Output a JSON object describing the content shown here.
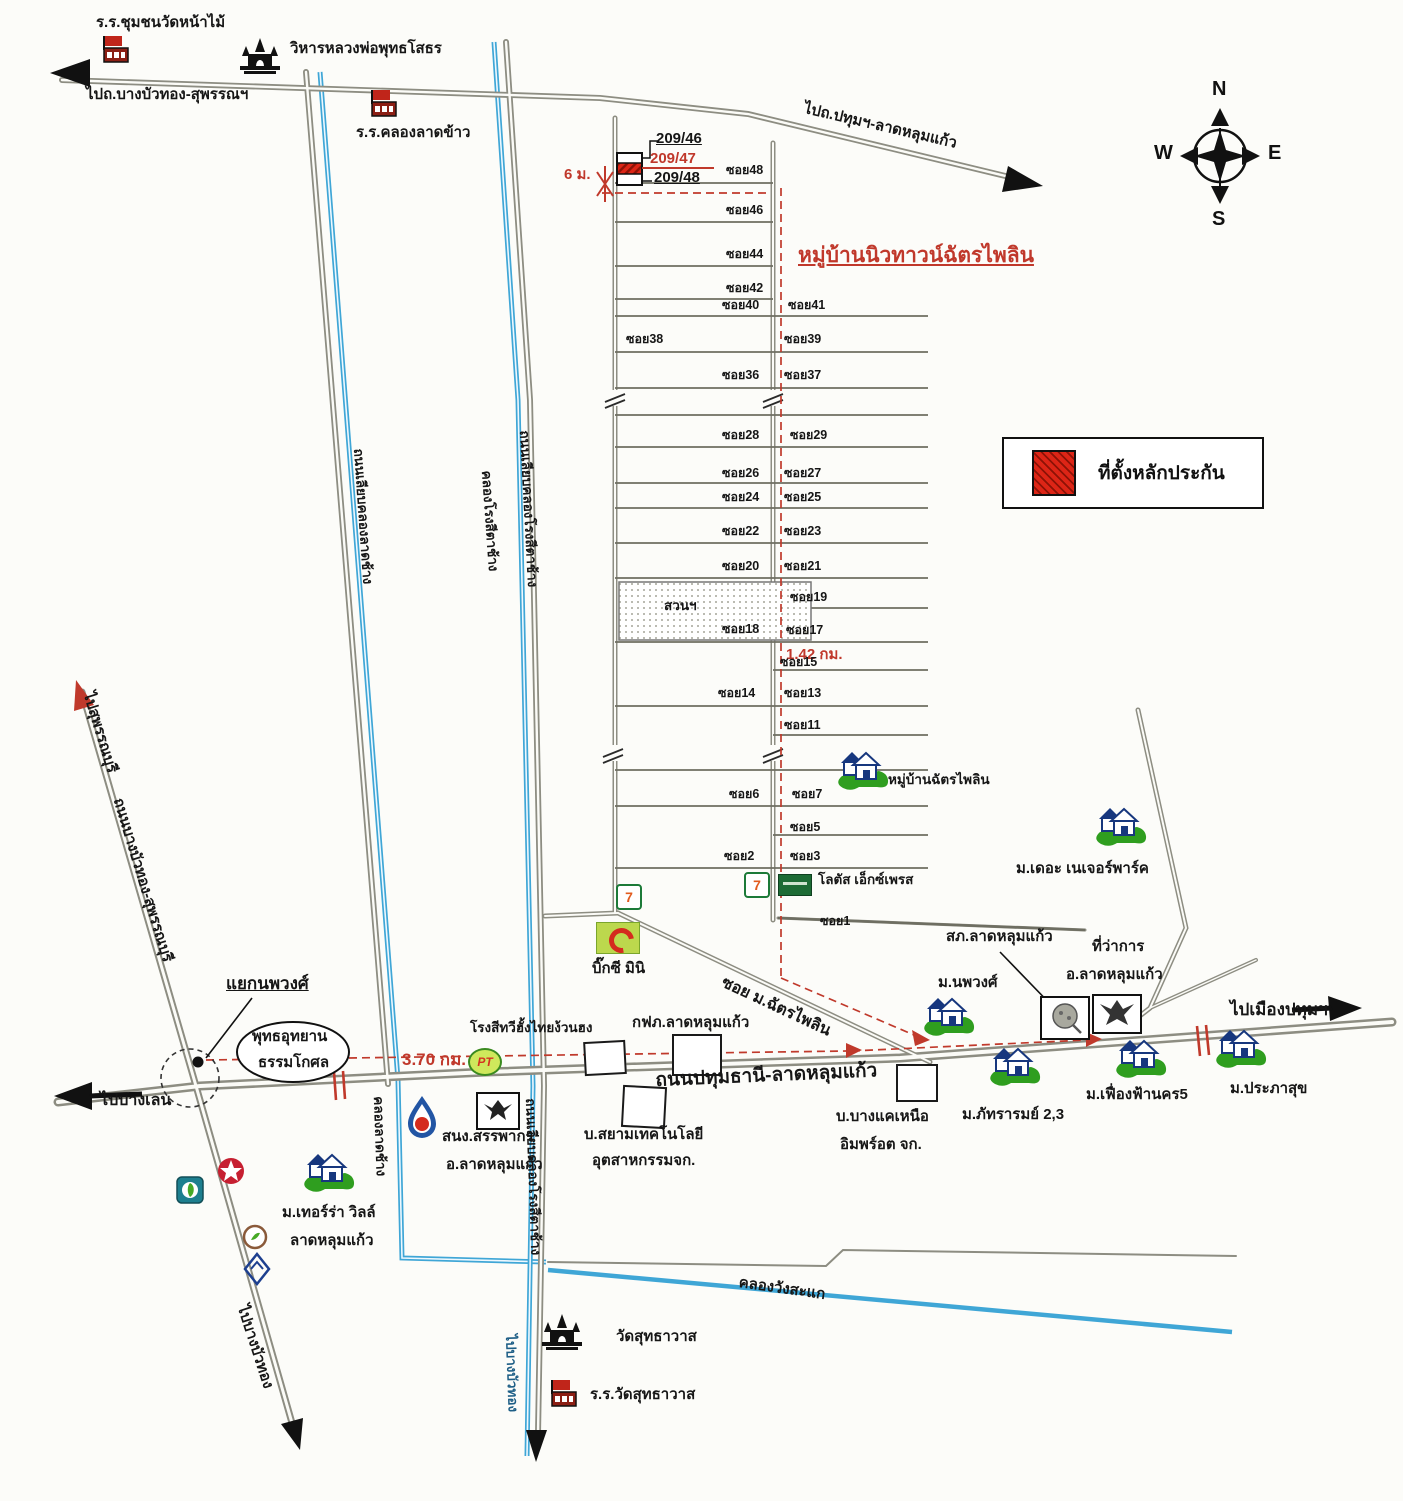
{
  "title": {
    "estate_name": "หมู่บ้านนิวทาวน์ฉัตรไพลิน"
  },
  "legend": {
    "label": "ที่ตั้งหลักประกัน",
    "swatch_color": "#dd2516"
  },
  "compass": {
    "n": "N",
    "e": "E",
    "s": "S",
    "w": "W"
  },
  "collateral": {
    "unit_top": "209/46",
    "unit_mid": "209/47",
    "unit_bottom": "209/48",
    "frontage": "6 ม."
  },
  "distances": {
    "soi_length": "1.42 กม.",
    "to_junction": "3.70 กม."
  },
  "directions": {
    "west_top": "ไปถ.บางบัวทอง-สุพรรณฯ",
    "northeast": "ไปถ.ปทุมฯ-ลาดหลุมแก้ว",
    "suphanburi": "ไปสุพรรณบุรี",
    "banglen": "ไปบางเลน",
    "pathum": "ไปเมืองปทุมฯ",
    "bangbuathong_sw": "ไปบางบัวทอง",
    "bangbuathong_s": "ไปบางบัวทอง"
  },
  "roads": {
    "main": "ถนนปทุมธานี-ลาดหลุมแก้ว",
    "bbt_suphan": "ถนนบางบัวทอง-สุพรรณบุรี",
    "left_canal_road": "ถนนเลียบคลองลาดช้าง",
    "rongsi_road_north": "ถนนเลียบคลองโรงสีตาช้าง",
    "rongsi_road_south": "ถนนเลียบคลองโรงสีตาช้าง",
    "estate_soi": "ซอย ม.ฉัตรไพลิน"
  },
  "canals": {
    "rongsi": "คลองโรงสีตาช้าง",
    "latchang": "คลองลาดช้าง",
    "wangsakae": "คลองวังสะแก"
  },
  "places": {
    "school_wat_namai": "ร.ร.ชุมชนวัดหน้าไม้",
    "wihan_luangpho": "วิหารหลวงพ่อพุทธโสธร",
    "school_khlong_latkhao": "ร.ร.คลองลาดข้าว",
    "village_chatpailin": "หมู่บ้านฉัตรไพลิน",
    "lotus_express": "โลตัส เอ็กซ์เพรส",
    "big_c_mini": "บิ๊กซี มินิ",
    "rice_mill": "โรงสีทวีฮั้งไทยง้วนฮง",
    "pea_office": "กฟภ.ลาดหลุมแก้ว",
    "siam_tech_line1": "บ.สยามเทคโนโลยี",
    "siam_tech_line2": "อุตสาหกรรมจก.",
    "bangkae_line1": "บ.บางแคเหนือ",
    "bangkae_line2": "อิมพร์อต จก.",
    "revenue_line1": "สนง.สรรพากร",
    "revenue_line2": "อ.ลาดหลุมแก้ว",
    "junction_nopphawong": "แยกนพวงศ์",
    "buddha_park_line1": "พุทธอุทยาน",
    "buddha_park_line2": "ธรรมโกศล",
    "terra_ville_line1": "ม.เทอร์ร่า วิลล์",
    "terra_ville_line2": "ลาดหลุมแก้ว",
    "wat_sutthawat": "วัดสุทธาวาส",
    "school_wat_sutthawat": "ร.ร.วัดสุทธาวาส",
    "nature_park": "ม.เดอะ เนเจอร์พาร์ค",
    "police_station": "สภ.ลาดหลุมแก้ว",
    "district_office_line1": "ที่ว่าการ",
    "district_office_line2": "อ.ลาดหลุมแก้ว",
    "nopphawong_village": "ม.นพวงศ์",
    "phattararom": "ม.ภัทรารมย์ 2,3",
    "fuangfa_nakhon5": "ม.เฟื่องฟ้านคร5",
    "prapasuk": "ม.ประภาสุข",
    "park": "สวนฯ"
  },
  "sois": {
    "left": [
      "ซอย48",
      "ซอย46",
      "ซอย44",
      "ซอย42",
      "ซอย40",
      "ซอย38",
      "ซอย36",
      "ซอย28",
      "ซอย26",
      "ซอย24",
      "ซอย22",
      "ซอย20",
      "ซอย18",
      "ซอย14",
      "ซอย6",
      "ซอย2"
    ],
    "right": [
      "ซอย41",
      "ซอย39",
      "ซอย37",
      "ซอย29",
      "ซอย27",
      "ซอย25",
      "ซอย23",
      "ซอย21",
      "ซอย19",
      "ซอย17",
      "ซอย15",
      "ซอย13",
      "ซอย11",
      "ซอย7",
      "ซอย5",
      "ซอย3",
      "ซอย1"
    ]
  },
  "icons": {
    "seven_label": "7",
    "pt_label": "PT"
  }
}
